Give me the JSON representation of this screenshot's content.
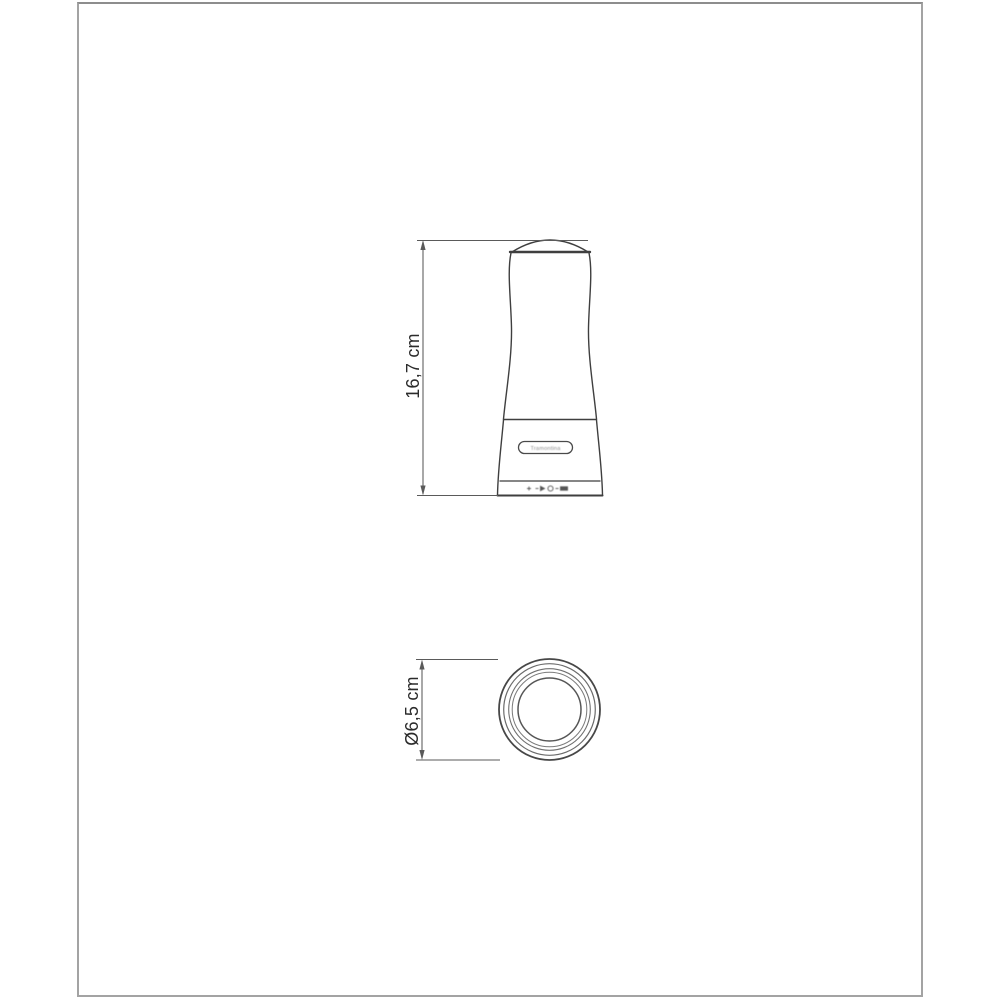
{
  "frame": {
    "border_color": "#a3a3a3",
    "background": "#ffffff"
  },
  "drawing": {
    "line_color": "#3f3f3f",
    "dimension_color": "#5a5a5a",
    "label_color": "#2b2b2b",
    "front_view": {
      "height_label": "16,7 cm",
      "logo_text": "Tramontina"
    },
    "top_view": {
      "diameter_label": "Ø6,5 cm"
    }
  }
}
